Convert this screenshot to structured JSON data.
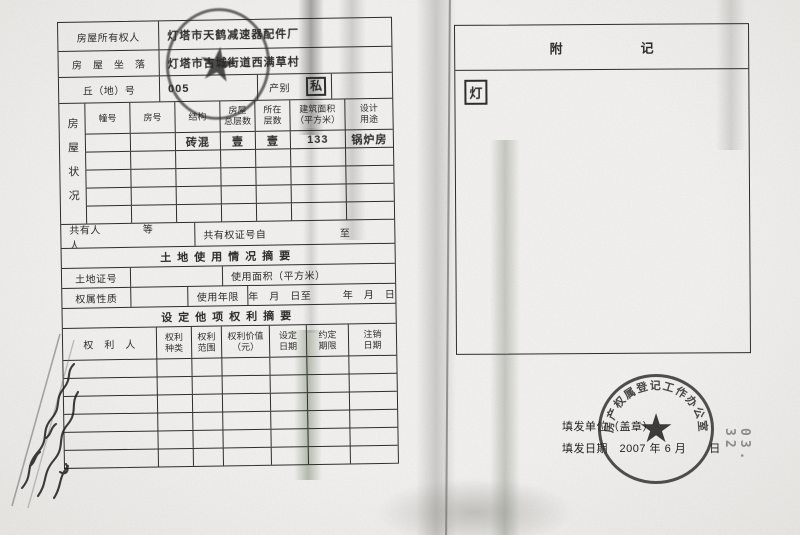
{
  "paper": {
    "background": "#f2f1ef",
    "ink": "#2d2d2d",
    "seal_color": "#2a2a2a",
    "smudge_green": "#6e7a63"
  },
  "left_page": {
    "owner_label": "房屋所有权人",
    "owner_value": "灯塔市天鹤减速器配件厂",
    "address_label": "房　屋　坐　落",
    "address_value": "灯塔市古城街道西满草村",
    "plot_label": "丘（地）号",
    "plot_value": "005",
    "category_label": "产别",
    "category_value": "私",
    "status_table": {
      "side_label": "房屋状况",
      "headers": [
        "幢号",
        "房号",
        "结构",
        "房屋\n总层数",
        "所在\n层数",
        "建筑面积\n（平方米）",
        "设计\n用途"
      ],
      "first_row": [
        "",
        "",
        "砖混",
        "壹",
        "壹",
        "133",
        "锅炉房"
      ],
      "empty_rows": 4
    },
    "co_owner_left": "共有人　　　　等　　　人",
    "co_owner_right": "共有权证号自　　　　　　　至",
    "land": {
      "section_title": "土地使用情况摘要",
      "cert_label": "土地证号",
      "cert_value": "",
      "area_label": "使用面积（平方米）",
      "tenure_label": "权属性质",
      "tenure_value": "",
      "term_label": "使用年限",
      "term_value": "年　月　日至　　　年　月　日"
    },
    "rights": {
      "section_title": "设定他项权利摘要",
      "headers": [
        "权　利　人",
        "权利\n种类",
        "权利\n范围",
        "权利价值\n（元）",
        "设定\n日期",
        "约定\n期限",
        "注销\n日期"
      ],
      "empty_rows": 6
    }
  },
  "right_page": {
    "title": "附　　　　　　记",
    "note_mark": "灯",
    "issue_unit_line": "填发单位（盖章）",
    "issue_date_line": "填发日期　2007 年 6 月　　日",
    "seal": {
      "arc_text": "房产权属登记工作办公室",
      "symbol": "★"
    }
  },
  "top_seal": {
    "symbol": "★"
  },
  "margin_notes": {
    "rotated_number": "03.  32"
  }
}
